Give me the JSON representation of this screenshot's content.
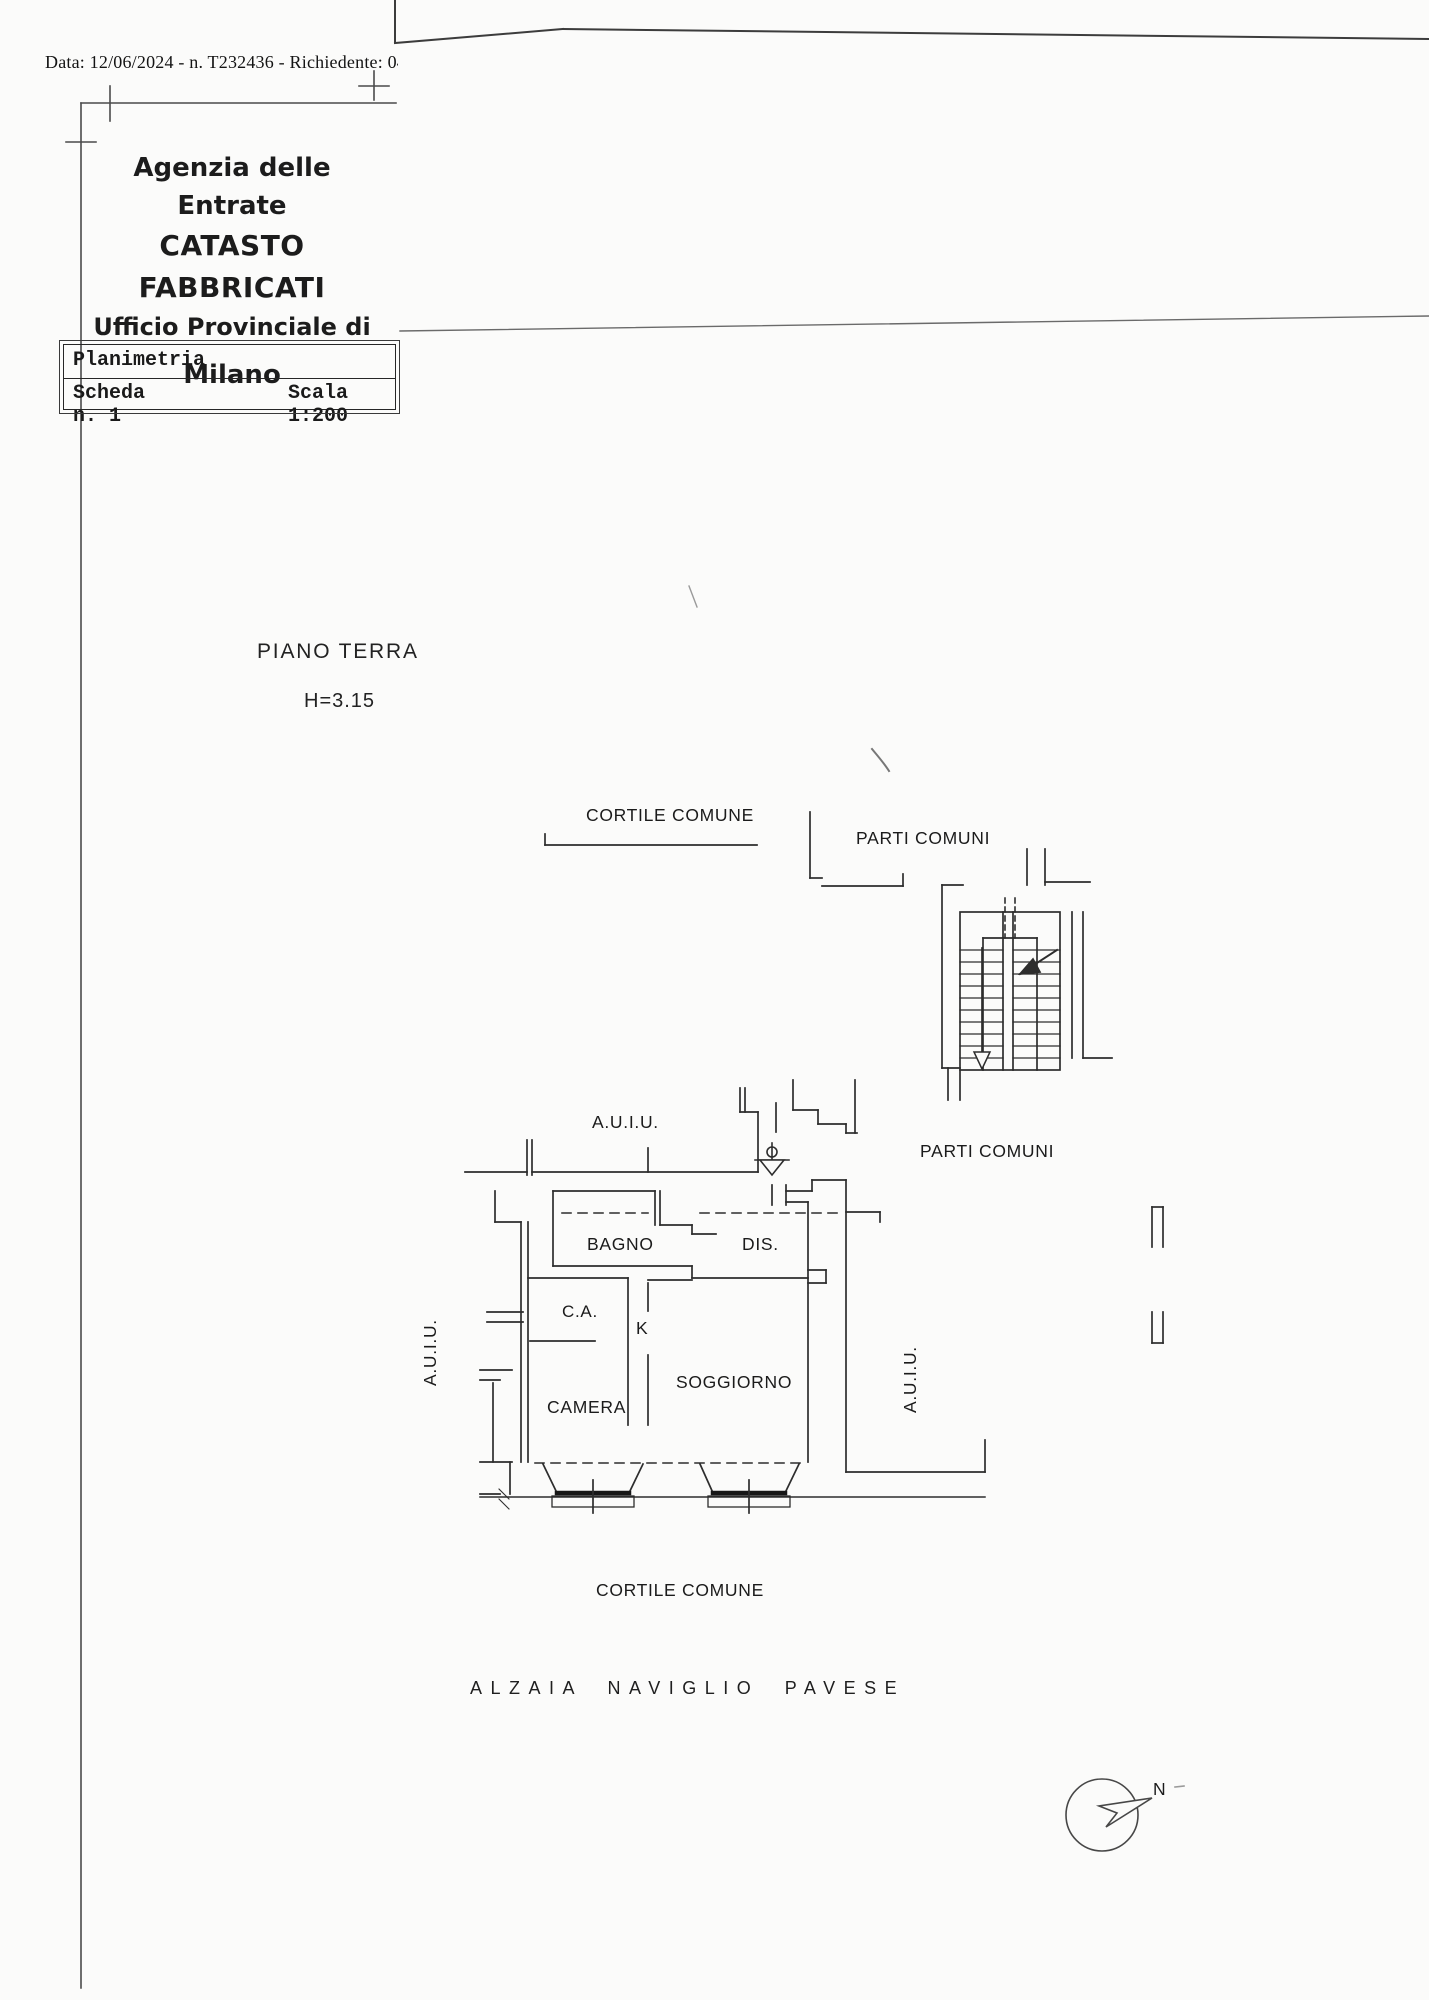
{
  "page": {
    "scan_header": "Data: 12/06/2024 - n. T232436 - Richiedente: 0462608",
    "office": {
      "line1": "Agenzia delle Entrate",
      "line2": "CATASTO FABBRICATI",
      "line3": "Ufficio Provinciale di",
      "line4": "Milano"
    },
    "info_box": {
      "row1": "Planimetria",
      "row2_left": "Scheda n. 1",
      "row2_right": "Scala 1:200"
    },
    "floor": {
      "title": "PIANO TERRA",
      "height": "H=3.15"
    }
  },
  "plan": {
    "labels": {
      "cortile_top": "CORTILE COMUNE",
      "parti_comuni_top": "PARTI COMUNI",
      "auiu_center": "A.U.I.U.",
      "parti_comuni_right": "PARTI COMUNI",
      "bagno": "BAGNO",
      "dis": "DIS.",
      "ca": "C.A.",
      "k": "K",
      "soggiorno": "SOGGIORNO",
      "camera": "CAMERA",
      "auiu_left": "A.U.I.U.",
      "auiu_right": "A.U.I.U.",
      "cortile_bottom": "CORTILE COMUNE",
      "street": "ALZAIA NAVIGLIO PAVESE",
      "compass_north": "N"
    }
  }
}
